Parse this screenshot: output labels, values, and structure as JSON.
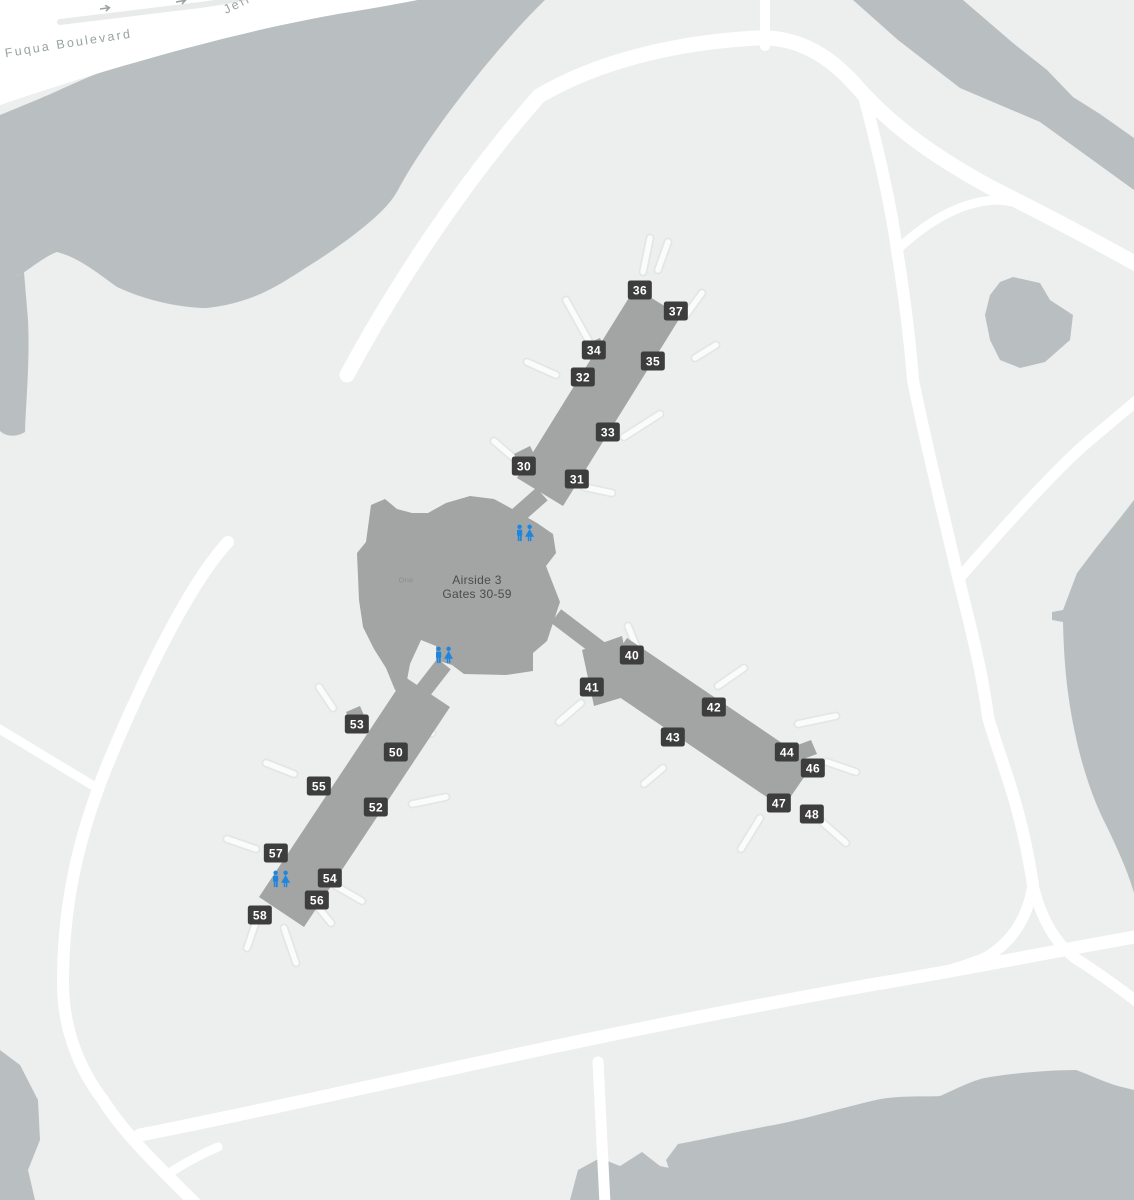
{
  "map": {
    "title": {
      "line1": "Airside 3",
      "line2": "Gates 30-59",
      "x": 477,
      "y": 573
    },
    "street": {
      "name": "Jeff Fuqua Boulevard"
    },
    "poi": {
      "label": "One",
      "x": 406,
      "y": 580
    },
    "gates": [
      {
        "id": "30",
        "x": 524,
        "y": 466
      },
      {
        "id": "31",
        "x": 577,
        "y": 479
      },
      {
        "id": "32",
        "x": 583,
        "y": 377
      },
      {
        "id": "33",
        "x": 608,
        "y": 432
      },
      {
        "id": "34",
        "x": 594,
        "y": 350
      },
      {
        "id": "35",
        "x": 653,
        "y": 361
      },
      {
        "id": "36",
        "x": 640,
        "y": 290
      },
      {
        "id": "37",
        "x": 676,
        "y": 311
      },
      {
        "id": "40",
        "x": 632,
        "y": 655
      },
      {
        "id": "41",
        "x": 592,
        "y": 687
      },
      {
        "id": "42",
        "x": 714,
        "y": 707
      },
      {
        "id": "43",
        "x": 673,
        "y": 737
      },
      {
        "id": "44",
        "x": 787,
        "y": 752
      },
      {
        "id": "46",
        "x": 813,
        "y": 768
      },
      {
        "id": "47",
        "x": 779,
        "y": 803
      },
      {
        "id": "48",
        "x": 812,
        "y": 814
      },
      {
        "id": "50",
        "x": 396,
        "y": 752
      },
      {
        "id": "52",
        "x": 376,
        "y": 807
      },
      {
        "id": "53",
        "x": 357,
        "y": 724
      },
      {
        "id": "54",
        "x": 330,
        "y": 878
      },
      {
        "id": "55",
        "x": 319,
        "y": 786
      },
      {
        "id": "56",
        "x": 317,
        "y": 900
      },
      {
        "id": "57",
        "x": 276,
        "y": 853
      },
      {
        "id": "58",
        "x": 260,
        "y": 915
      }
    ],
    "restrooms": [
      {
        "x": 525,
        "y": 533
      },
      {
        "x": 444,
        "y": 655
      },
      {
        "x": 281,
        "y": 879
      }
    ],
    "colors": {
      "background": "#edefef",
      "water": "#b9bfc0",
      "road": "#ffffff",
      "terminal": "#a3a4a4",
      "gate_badge": "#3d3d3d",
      "gate_badge_text": "#ffffff",
      "restroom_blue": "#1d86df",
      "street_text": "#9aa2a2",
      "terminal_text": "#4c4c4c"
    }
  }
}
